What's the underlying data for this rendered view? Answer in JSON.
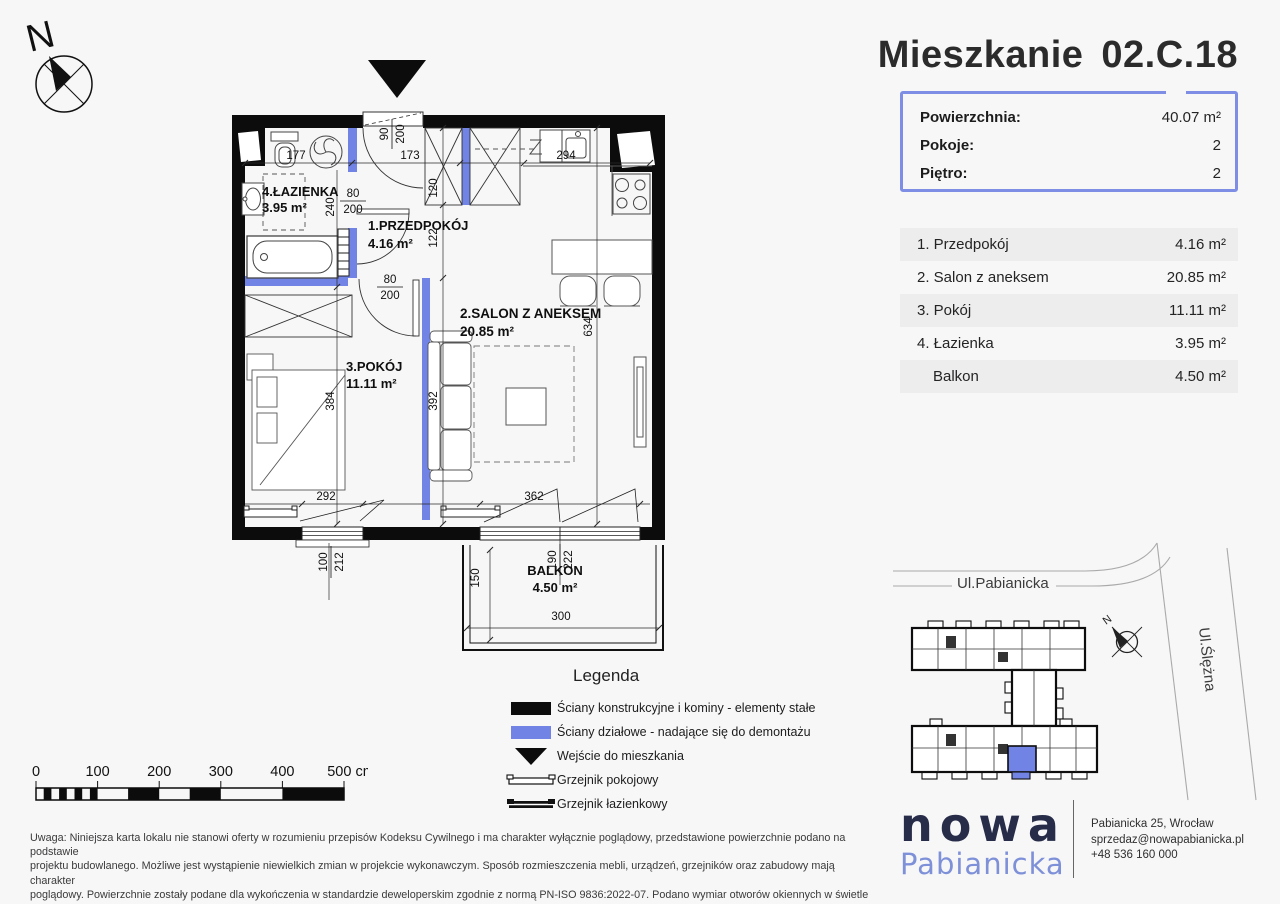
{
  "title": {
    "label": "Mieszkanie",
    "number": "02.C.18"
  },
  "summary": {
    "rows": [
      {
        "label": "Powierzchnia:",
        "value": "40.07 m²"
      },
      {
        "label": "Pokoje:",
        "value": "2"
      },
      {
        "label": "Piętro:",
        "value": "2"
      }
    ]
  },
  "rooms": [
    {
      "name": "1. Przedpokój",
      "area": "4.16 m²"
    },
    {
      "name": "2. Salon z aneksem",
      "area": "20.85 m²"
    },
    {
      "name": "3. Pokój",
      "area": "11.11 m²"
    },
    {
      "name": "4. Łazienka",
      "area": "3.95 m²"
    },
    {
      "name": "Balkon",
      "area": "4.50 m²"
    }
  ],
  "plan": {
    "north": "N",
    "labels": {
      "bath_name": "4.ŁAZIENKA",
      "bath_area": "3.95 m²",
      "hall_name": "1.PRZEDPOKÓJ",
      "hall_area": "4.16  m²",
      "salon_name": "2.SALON Z ANEKSEM",
      "salon_area": "20.85 m²",
      "room_name": "3.POKÓJ",
      "room_area": "11.11  m²",
      "balcony_name": "BALKON",
      "balcony_area": "4.50 m²"
    },
    "dims": {
      "d177": "177",
      "d173": "173",
      "d294": "294",
      "d240": "240",
      "d120": "120",
      "d122": "122",
      "d384": "384",
      "d392": "392",
      "d634": "634",
      "d292": "292",
      "d362": "362",
      "d150": "150",
      "d300": "300"
    },
    "fracs": {
      "entry": {
        "a": "90",
        "b": "200"
      },
      "bath": {
        "a": "80",
        "b": "200"
      },
      "room": {
        "a": "80",
        "b": "200"
      },
      "win_left": {
        "a": "100",
        "b": "212"
      },
      "win_right": {
        "a": "190",
        "b": "222"
      }
    }
  },
  "legend": {
    "title": "Legenda",
    "items": [
      {
        "icon": "wall-solid-swatch",
        "label": "Ściany konstrukcyjne i kominy - elementy stałe"
      },
      {
        "icon": "wall-partition-swatch",
        "label": "Ściany działowe - nadające się do demontażu"
      },
      {
        "icon": "entrance-triangle",
        "label": "Wejście do mieszkania"
      },
      {
        "icon": "radiator-room-glyph",
        "label": "Grzejnik pokojowy"
      },
      {
        "icon": "radiator-bath-glyph",
        "label": "Grzejnik łazienkowy"
      }
    ]
  },
  "scale_bar": {
    "labels": [
      "0",
      "100",
      "200",
      "300",
      "400",
      "500 cm"
    ]
  },
  "disclaimer_lines": [
    "Uwaga: Niniejsza karta lokalu nie stanowi oferty w rozumieniu przepisów Kodeksu Cywilnego i ma charakter wyłącznie poglądowy, przedstawione powierzchnie podano na podstawie",
    "projektu budowlanego. Możliwe jest wystąpienie niewielkich zmian w projekcie wykonawczym. Sposób rozmieszczenia mebli, urządzeń, grzejników oraz zabudowy mają charakter",
    "poglądowy. Powierzchnie zostały podane dla wykończenia w standardzie deweloperskim zgodnie z normą PN-ISO 9836:2022-07. Podano wymiar otworów okiennych w świetle muru,",
    "otworów drzwiowych w świetle przejścia."
  ],
  "map": {
    "street_top": "Ul.Pabianicka",
    "street_right": "Ul.Ślężna",
    "north": "N"
  },
  "footer": {
    "brand_line1": "nowa",
    "brand_line2": "Pabianicka",
    "address": "Pabianicka 25, Wrocław",
    "email": "sprzedaz@nowapabianicka.pl",
    "phone": "+48 536 160 000"
  },
  "colors": {
    "wall": "#0c0c0c",
    "partition": "#7183e4",
    "accent": "#7d8ee4",
    "row_alt": "#ededee"
  }
}
